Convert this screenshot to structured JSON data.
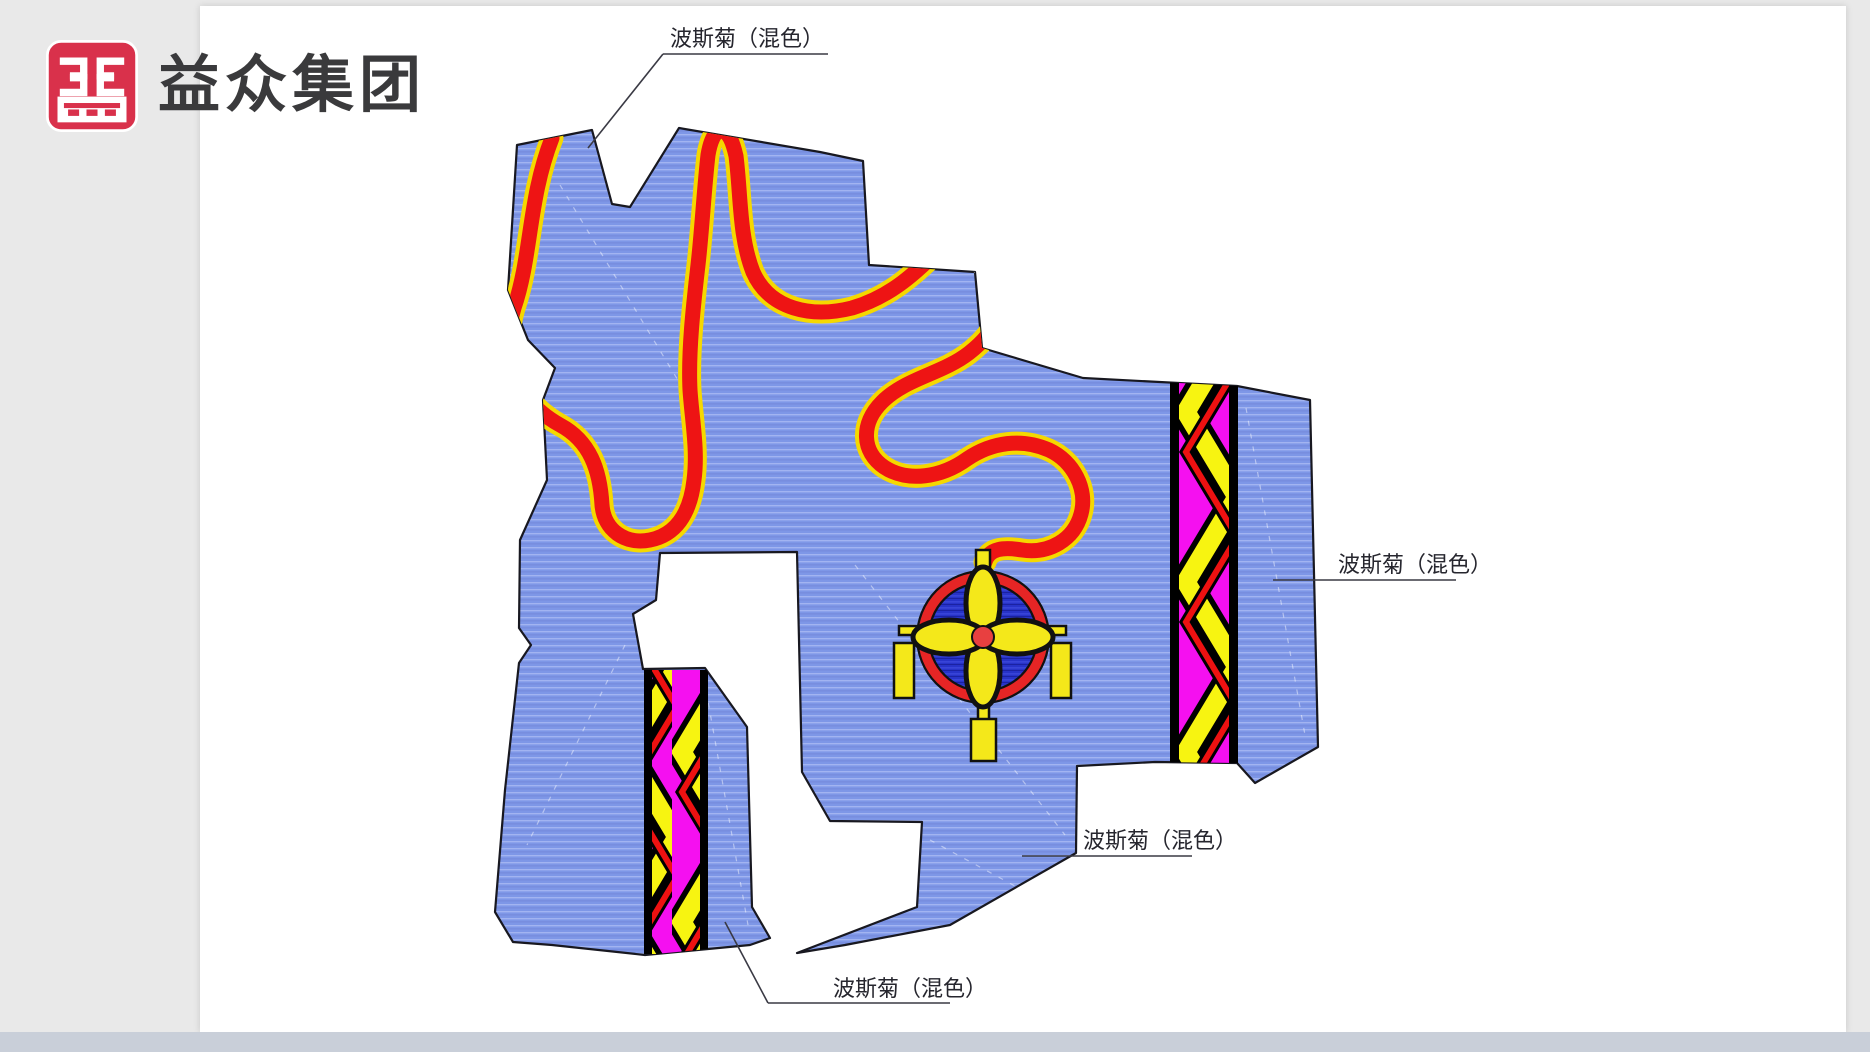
{
  "page": {
    "background": "#E9E9E9",
    "canvas": "#FFFFFF",
    "footer": "#C9CFD9"
  },
  "logo": {
    "text": "益众集团",
    "icon": "yizhong-grid-seal",
    "colors": {
      "icon_bg": "#D9314B",
      "glyph": "#FFFFFF",
      "logo_text": "#3A3A3C"
    }
  },
  "labels": {
    "top": {
      "text": "波斯菊（混色）"
    },
    "right": {
      "text": "波斯菊（混色）"
    },
    "middle": {
      "text": "波斯菊（混色）"
    },
    "bottom": {
      "text": "波斯菊（混色）"
    }
  },
  "drawing": {
    "description": "flower-bed planting plan with meandering ribbon, chevron flower bands and knot medallion",
    "colors": {
      "bed_blue": "#7E97E7",
      "bed_blue_flat": "#8CA2EC",
      "outline": "#181820",
      "ribbon_red": "#EE1414",
      "ribbon_edge_yellow": "#F5D800",
      "band_magenta": "#F510F0",
      "band_yellow": "#F7F411",
      "band_red": "#EE1111",
      "medallion_blue": "#2733C8",
      "medallion_ring": "#E62525",
      "pendant_yellow": "#F4E81A",
      "leader_line": "#3A3A44"
    }
  }
}
